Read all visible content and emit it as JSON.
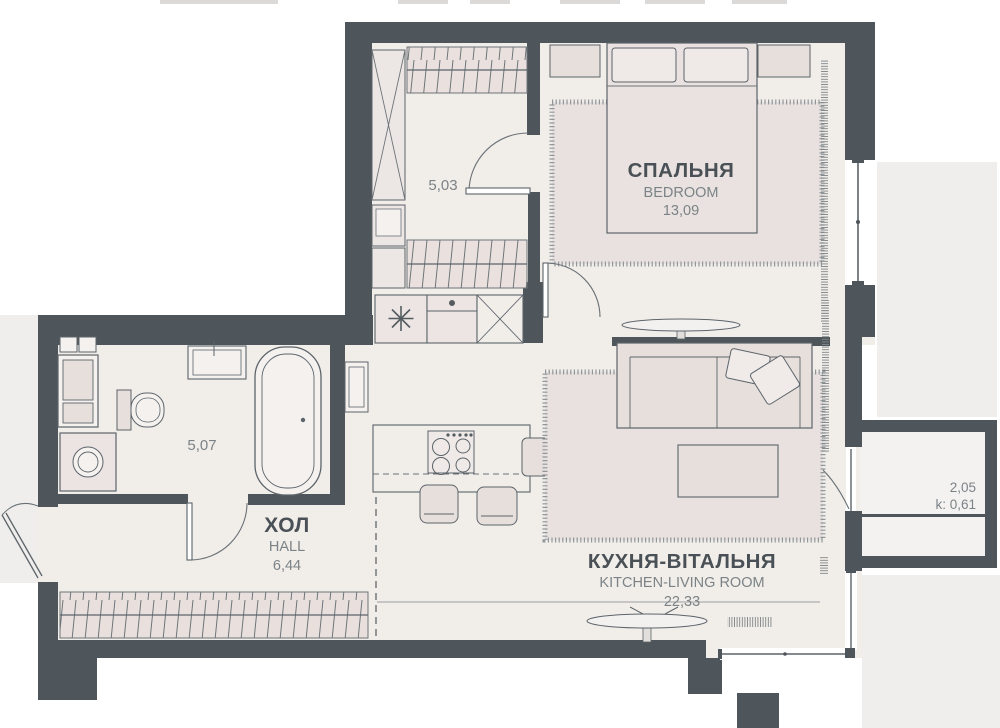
{
  "plan": {
    "rooms": {
      "wardrobe": {
        "area": "5,03"
      },
      "bedroom": {
        "name_uk": "СПАЛЬНЯ",
        "name_en": "BEDROOM",
        "area": "13,09"
      },
      "bathroom": {
        "area": "5,07"
      },
      "hall": {
        "name_uk": "ХОЛ",
        "name_en": "HALL",
        "area": "6,44"
      },
      "kitchen_living": {
        "name_uk": "КУХНЯ-ВІТАЛЬНЯ",
        "name_en": "KITCHEN-LIVING ROOM",
        "area": "22,33"
      },
      "balcony": {
        "area": "2,05",
        "coefficient": "k: 0,61"
      }
    },
    "colors": {
      "wall": "#4e565c",
      "floor": "#f1ede9",
      "furniture_fill": "#e7dfdc",
      "hatch_fill": "#eae1df",
      "exterior_area": "#efeeec",
      "outline": "#5c646a",
      "label_primary": "#495156",
      "label_secondary": "#7b8387"
    },
    "fixtures": {
      "wardrobe_room": [
        "wardrobe-rail",
        "mirror-cabinet",
        "drawer-unit"
      ],
      "bedroom": [
        "double-bed",
        "pillow",
        "nightstand",
        "rug",
        "tv",
        "curtain",
        "window"
      ],
      "bathroom": [
        "washbasin",
        "bathtub",
        "toilet",
        "washing-machine",
        "shelf-unit"
      ],
      "hall": [
        "built-in-wardrobe",
        "entrance-door"
      ],
      "kitchen_living": [
        "fridge-freezer",
        "sink-cabinet",
        "tall-cabinet",
        "kitchen-island",
        "cooktop",
        "bar-stool",
        "armchair",
        "sofa",
        "coffee-table",
        "rug",
        "tv",
        "balcony-door",
        "corner-window"
      ],
      "balcony": [
        "window-band"
      ]
    }
  }
}
